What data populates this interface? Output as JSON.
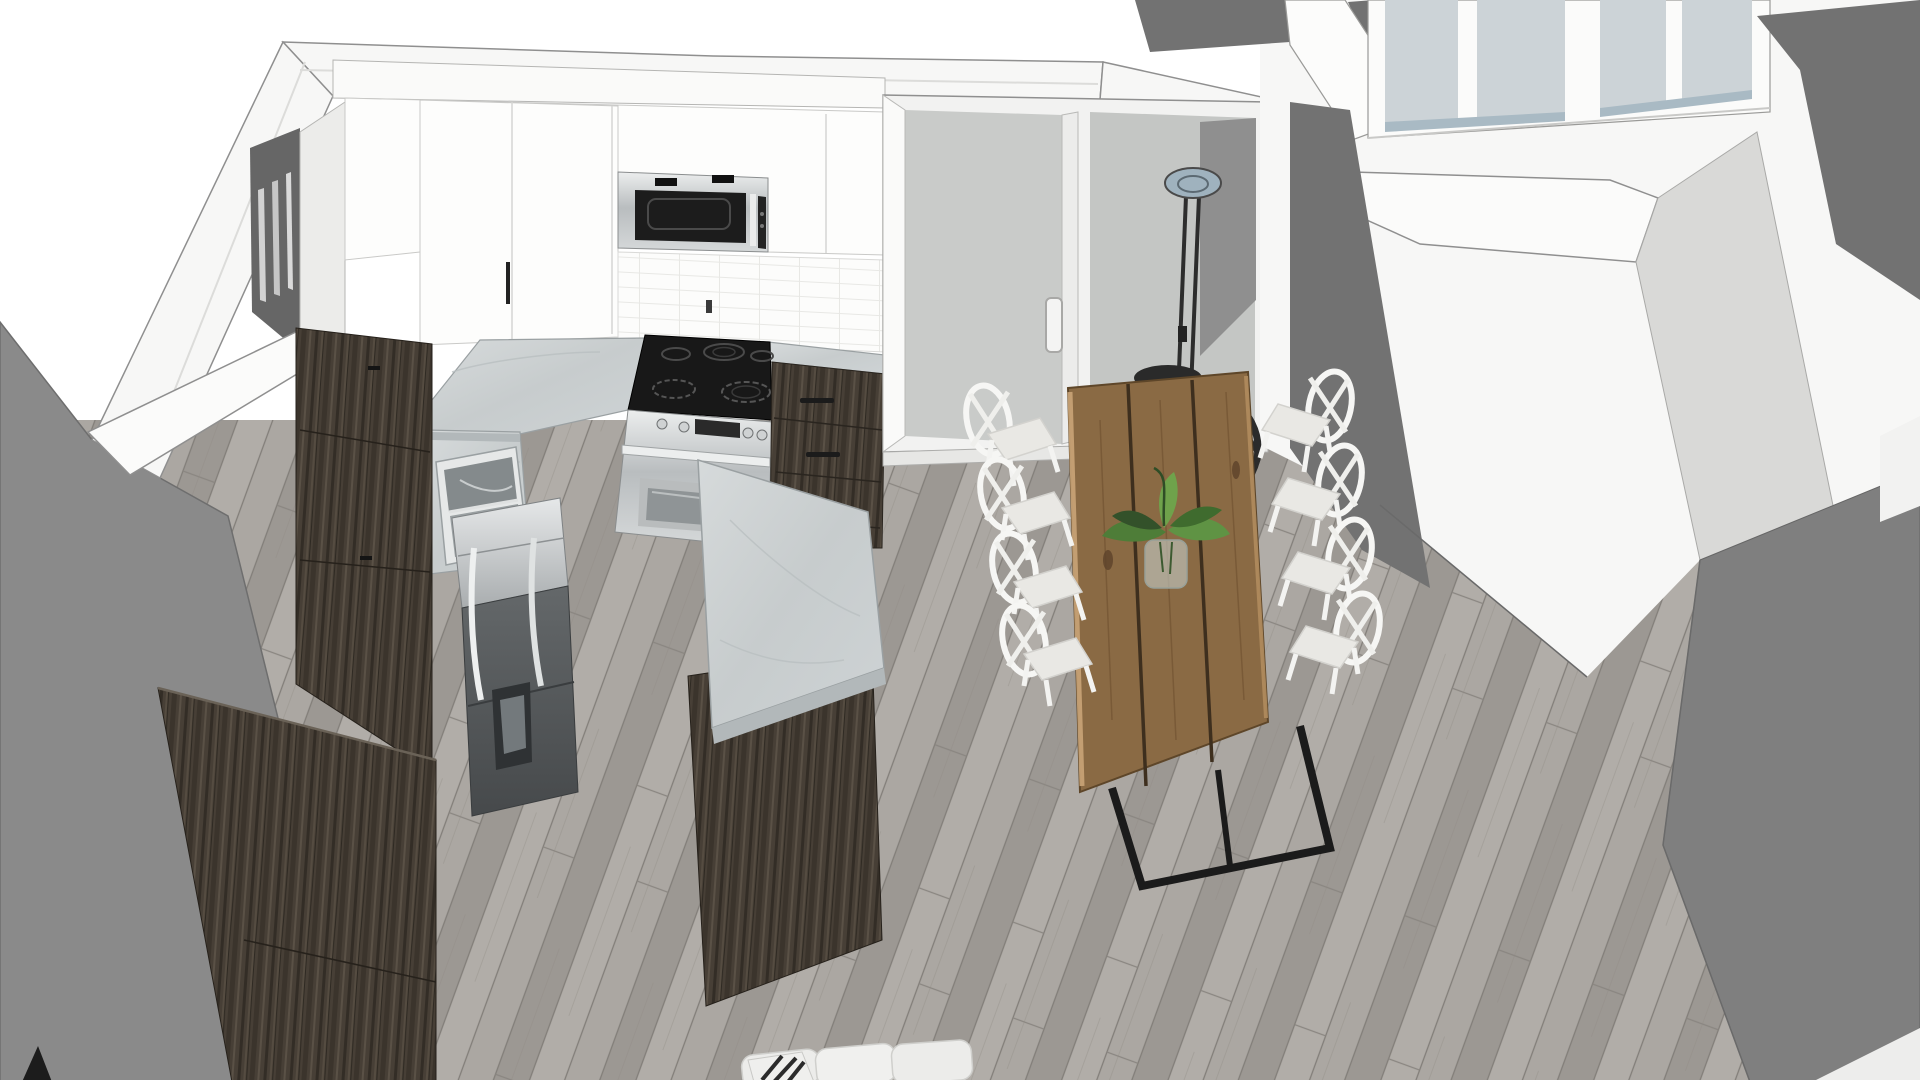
{
  "scene": {
    "kind": "3d-interior-rendering",
    "view": "elevated corner view of kitchen and dining area"
  },
  "palette": {
    "bg-white": "#ffffff",
    "wall-white": "#f7f7f6",
    "wall-white-shade": "#ebebea",
    "wall-gray": "#8a8a8a",
    "wall-gray-dark": "#727272",
    "interior-shadow": "#666666",
    "edge-line": "#5f5f5f",
    "floor-base": "#a6a29d",
    "floor-seam": "#827e79",
    "cabinet-wood": "#473f36",
    "cabinet-wood-dark": "#332d26",
    "marble": "#ced3d5",
    "marble-edge": "#b2b8ba",
    "stainless": "#d7dadb",
    "appliance-black": "#181818",
    "glass-gray": "#c9cbc9",
    "window-glass": "#ccd3d7",
    "sill-blue": "#a9bac4",
    "table-wood": "#8a6a44",
    "table-wood-light": "#c9a478",
    "table-gap": "#3e2f1e",
    "metal-black": "#1b1b1b",
    "fixture-black": "#2b2b2b",
    "chair-white": "#f6f6f4",
    "seat-gray": "#e9e8e4",
    "plant-green": "#55833c",
    "fridge-gray": "#565a5c"
  },
  "objects": [
    {
      "id": "hardwood-floor",
      "label": "Gray hardwood plank floor"
    },
    {
      "id": "left-wall",
      "label": "Left exterior wall"
    },
    {
      "id": "wall-band",
      "label": "White wall top band"
    },
    {
      "id": "interior-wall",
      "label": "Shadowed interior wall corner with window"
    },
    {
      "id": "upper-cabinets",
      "label": "White upper kitchen cabinets"
    },
    {
      "id": "microwave",
      "label": "Over-the-range stainless microwave"
    },
    {
      "id": "backsplash",
      "label": "White tile backsplash"
    },
    {
      "id": "countertop",
      "label": "Marble countertop"
    },
    {
      "id": "cooktop",
      "label": "Black glass cooktop with burners"
    },
    {
      "id": "range",
      "label": "Stainless steel range oven"
    },
    {
      "id": "drawer-cabinets",
      "label": "Dark wood drawer cabinets"
    },
    {
      "id": "pantry",
      "label": "Dark wood pantry cabinets"
    },
    {
      "id": "sink",
      "label": "Stainless double-bowl sink"
    },
    {
      "id": "refrigerator",
      "label": "French-door refrigerator"
    },
    {
      "id": "island",
      "label": "Kitchen island with marble top"
    },
    {
      "id": "sliding-doors",
      "label": "Sliding glass patio doors"
    },
    {
      "id": "right-structure",
      "label": "Stairwell half-wall and windows"
    },
    {
      "id": "chandelier",
      "label": "Black orb pendant chandelier"
    },
    {
      "id": "dining-table",
      "label": "Live-edge wood dining table with metal base"
    },
    {
      "id": "plant",
      "label": "Green plant centerpiece in glass vase"
    },
    {
      "id": "chairs",
      "label": "White cross-back dining chairs"
    },
    {
      "id": "sofa",
      "label": "White sofa with patterned pillow"
    }
  ]
}
